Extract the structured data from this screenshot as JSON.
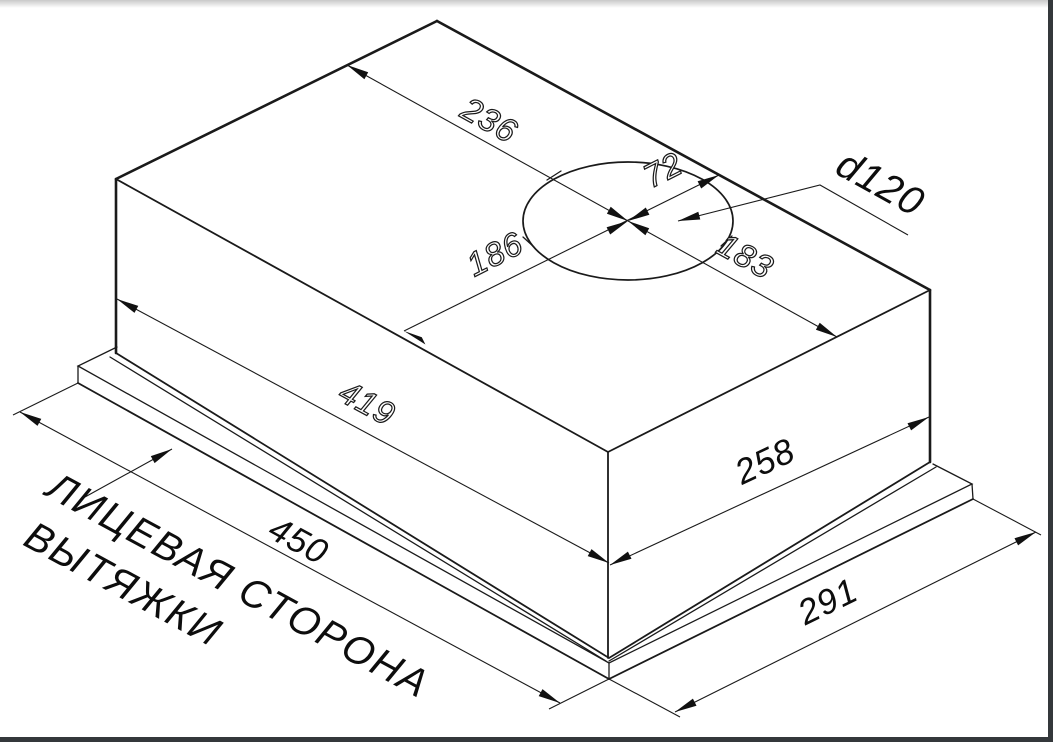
{
  "dimensions": {
    "hole_offset_back_left": "236",
    "hole_offset_back_right": "72",
    "hole_offset_front_left": "186",
    "hole_offset_front_right": "183",
    "duct_diameter": "d120",
    "body_length": "419",
    "body_depth": "258",
    "panel_length": "450",
    "panel_depth": "291"
  },
  "labels": {
    "front_side_line1": "ЛИЦЕВАЯ СТОРОНА",
    "front_side_line2": "ВЫТЯЖКИ"
  },
  "colors": {
    "line": "#1a1a1a",
    "background": "#ffffff",
    "window_frame": "#34383b"
  }
}
